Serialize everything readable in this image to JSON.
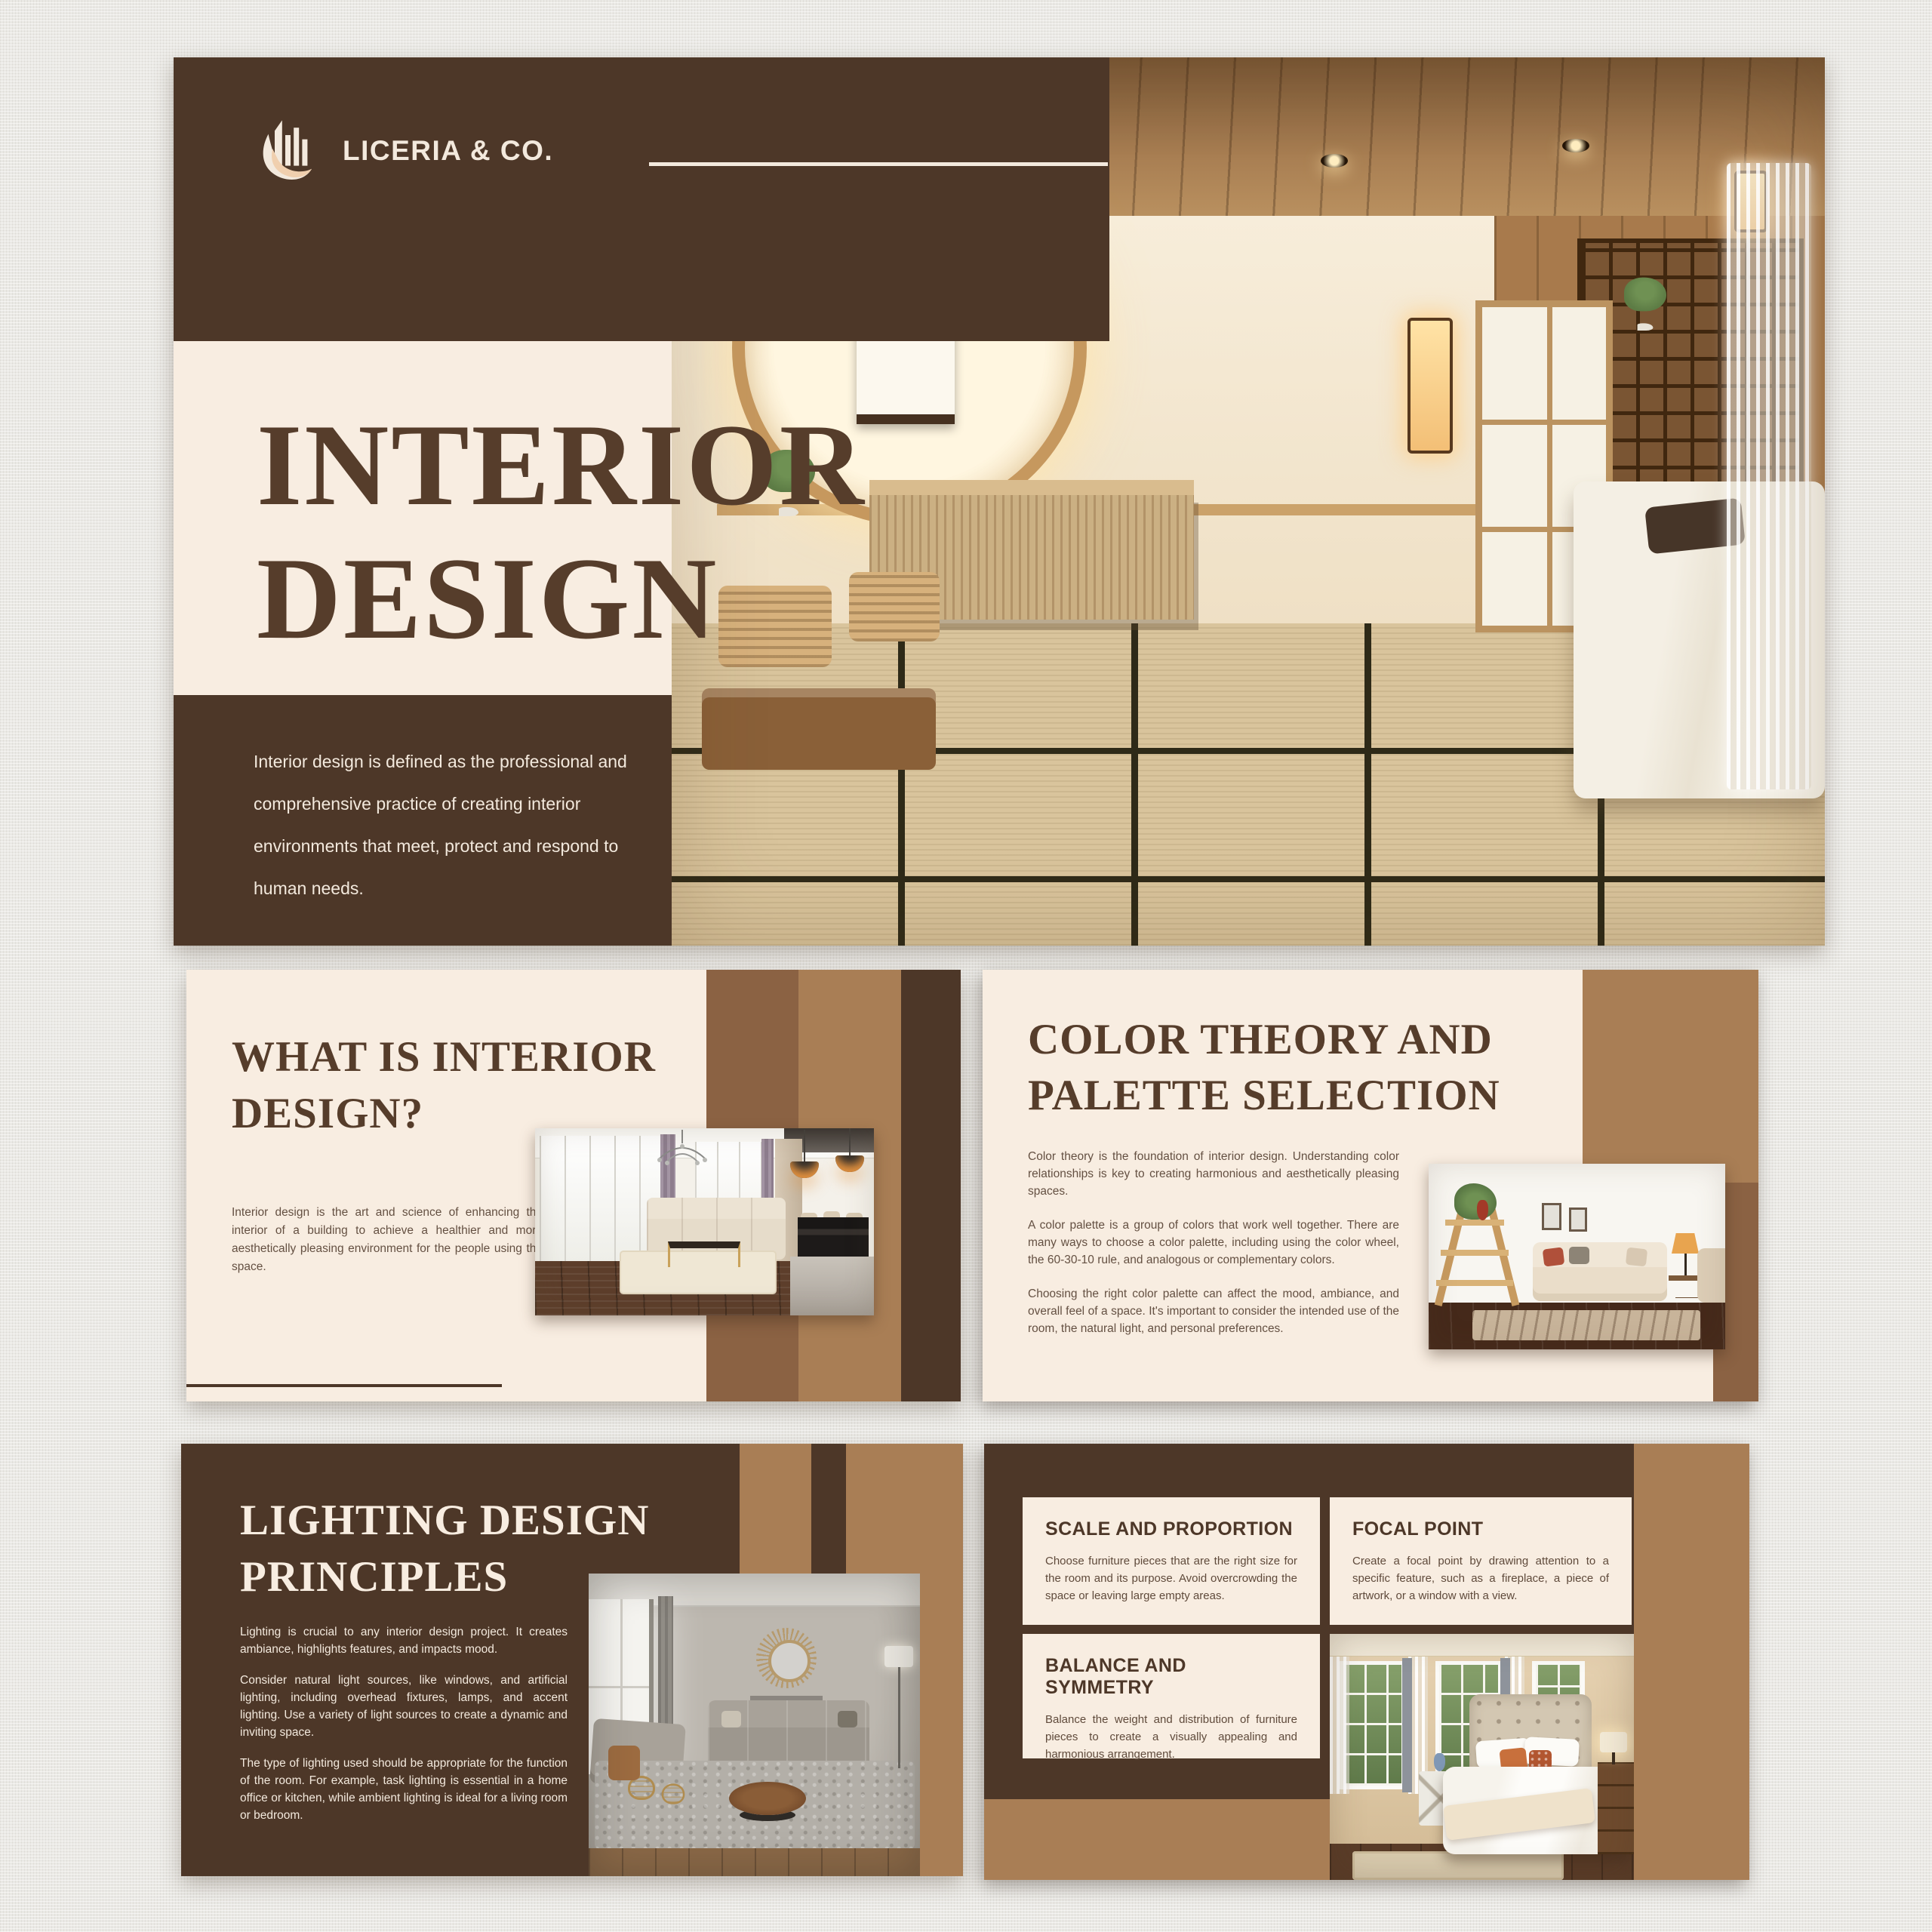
{
  "brand": {
    "name": "LICERIA & CO.",
    "logo_icon": "building-swoosh-icon"
  },
  "colors": {
    "canvas_background": "#eae9e5",
    "dark_brown": "#4d3728",
    "cream": "#f8ede1",
    "cream_text": "#f3e9dd",
    "tan_light": "#a97e55",
    "tan_mid": "#8b6243",
    "title_brown": "#563d2b",
    "body_text": "#645042"
  },
  "slides": {
    "title": {
      "line1": "INTERIOR",
      "line2": "DESIGN",
      "description": "Interior design is defined as the professional and comprehensive practice of creating interior environments that meet, protect and respond to human needs."
    },
    "what_is": {
      "line1": "WHAT IS INTERIOR",
      "line2": "DESIGN?",
      "body": "Interior design is the art and science of enhancing the interior of a building to achieve a healthier and more aesthetically pleasing environment for the people using the space."
    },
    "color_theory": {
      "line1": "COLOR THEORY AND",
      "line2": "PALETTE SELECTION",
      "paragraphs": [
        "Color theory is the foundation of interior design. Understanding color relationships is key to creating harmonious and aesthetically pleasing spaces.",
        "A color palette is a group of colors that work well together. There are many ways to choose a color palette, including using the color wheel, the 60-30-10 rule, and analogous or complementary colors.",
        "Choosing the right color palette can affect the mood, ambiance, and overall feel of a space. It's important to consider the intended use of the room, the natural light, and personal preferences."
      ]
    },
    "lighting": {
      "line1": "LIGHTING DESIGN",
      "line2": "PRINCIPLES",
      "paragraphs": [
        "Lighting is crucial to any interior design project. It creates ambiance, highlights features, and impacts mood.",
        "Consider natural light sources, like windows, and artificial lighting, including overhead fixtures, lamps, and accent lighting. Use a variety of light sources to create a dynamic and inviting space.",
        "The type of lighting used should be appropriate for the function of the room. For example, task lighting is essential in a home office or kitchen, while ambient lighting is ideal for a living room or bedroom."
      ]
    },
    "principles": {
      "cards": [
        {
          "heading": "SCALE AND PROPORTION",
          "body": "Choose furniture pieces that are the right size for the room and its purpose. Avoid overcrowding the space or leaving large empty areas."
        },
        {
          "heading": "FOCAL POINT",
          "body": "Create a focal point by drawing attention to a specific feature, such as a fireplace, a piece of artwork, or a window with a view."
        },
        {
          "heading": "BALANCE AND SYMMETRY",
          "body": "Balance the weight and distribution of furniture pieces to create a visually appealing and harmonious arrangement."
        }
      ]
    }
  },
  "photos": {
    "title_slide": "japanese-zen-bedroom",
    "what_is": "classic-bright-living-room",
    "color_theory": "neutral-living-room-with-ladder-shelf",
    "lighting": "gray-living-room",
    "principles": "bedroom-with-garden-view"
  }
}
